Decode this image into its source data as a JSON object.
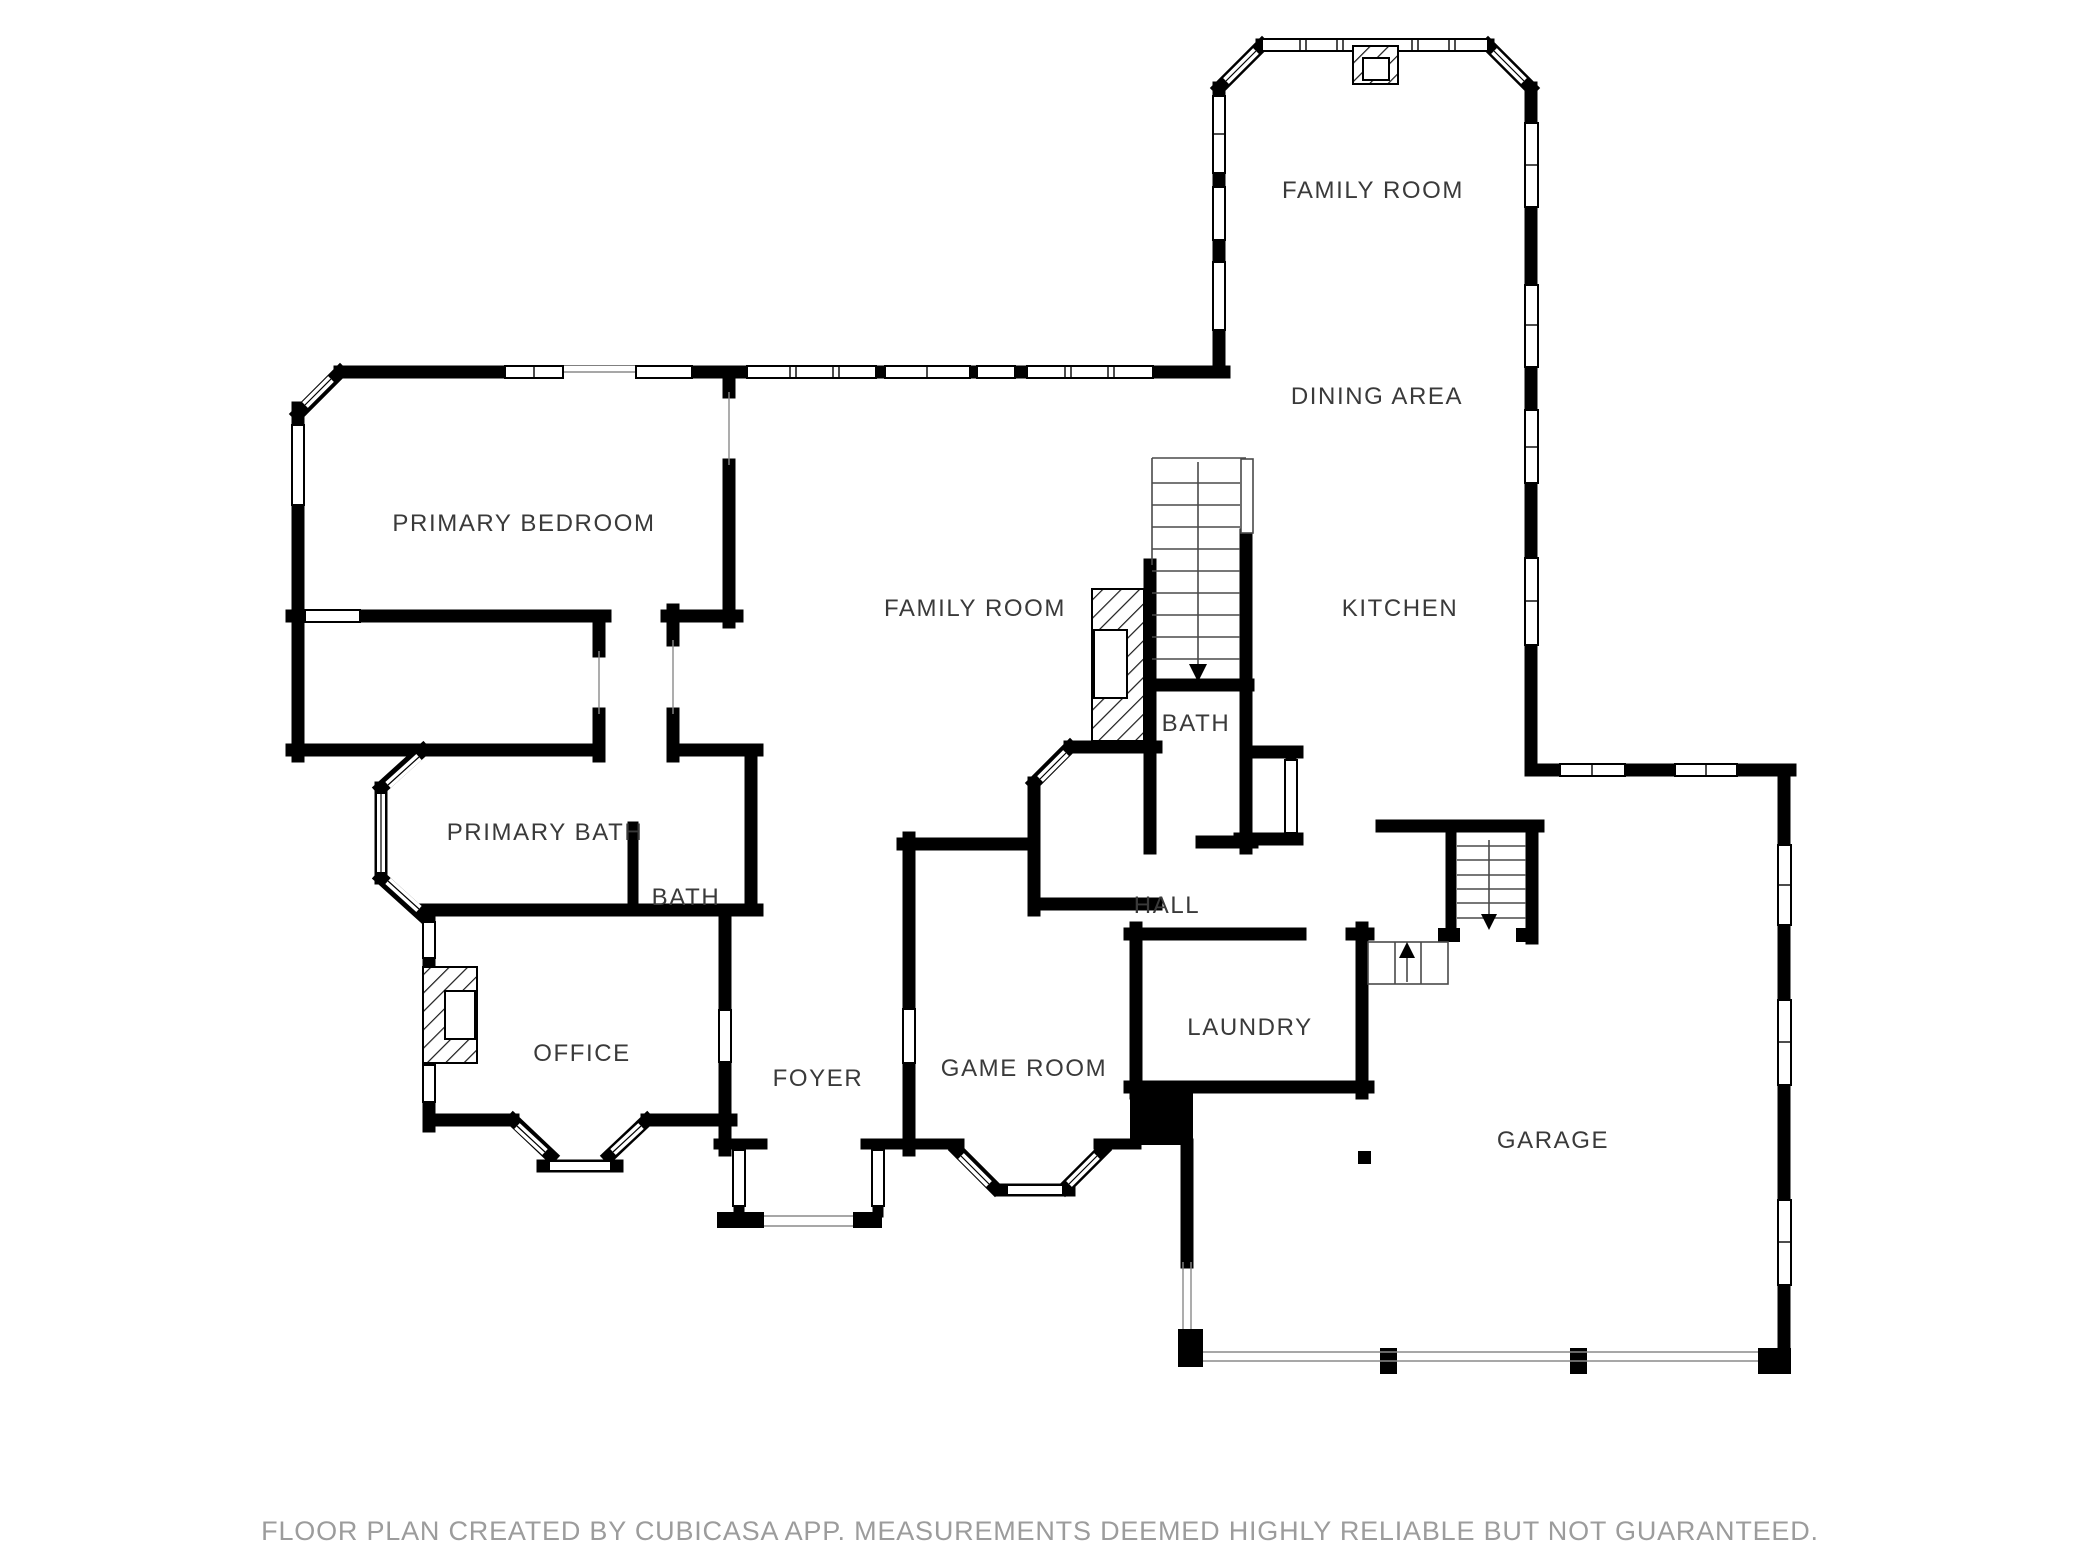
{
  "document": {
    "type": "floor-plan",
    "app_attribution": "CUBICASA",
    "colors": {
      "background": "#ffffff",
      "wall": "#000000",
      "window_fill": "#ffffff",
      "label_text": "#3a3a3a",
      "footer_text": "#9c9c9c"
    },
    "rooms": [
      {
        "id": "family-room-upper",
        "label": "FAMILY ROOM"
      },
      {
        "id": "dining-area",
        "label": "DINING AREA"
      },
      {
        "id": "primary-bedroom",
        "label": "PRIMARY BEDROOM"
      },
      {
        "id": "family-room-main",
        "label": "FAMILY ROOM"
      },
      {
        "id": "kitchen",
        "label": "KITCHEN"
      },
      {
        "id": "bath-center",
        "label": "BATH"
      },
      {
        "id": "primary-bath",
        "label": "PRIMARY BATH"
      },
      {
        "id": "bath-left",
        "label": "BATH"
      },
      {
        "id": "hall",
        "label": "HALL"
      },
      {
        "id": "office",
        "label": "OFFICE"
      },
      {
        "id": "foyer",
        "label": "FOYER"
      },
      {
        "id": "game-room",
        "label": "GAME ROOM"
      },
      {
        "id": "laundry",
        "label": "LAUNDRY"
      },
      {
        "id": "garage",
        "label": "GARAGE"
      }
    ],
    "icons": [
      {
        "name": "fireplace-icon",
        "count": 3
      },
      {
        "name": "stairs-down-arrow-icon",
        "count": 2
      },
      {
        "name": "stairs-up-arrow-icon",
        "count": 1
      },
      {
        "name": "window-icon",
        "count": 30
      },
      {
        "name": "garage-door-line-icon",
        "count": 3
      }
    ],
    "footer": {
      "text": "FLOOR PLAN CREATED BY CUBICASA APP. MEASUREMENTS DEEMED HIGHLY RELIABLE BUT NOT GUARANTEED."
    }
  }
}
